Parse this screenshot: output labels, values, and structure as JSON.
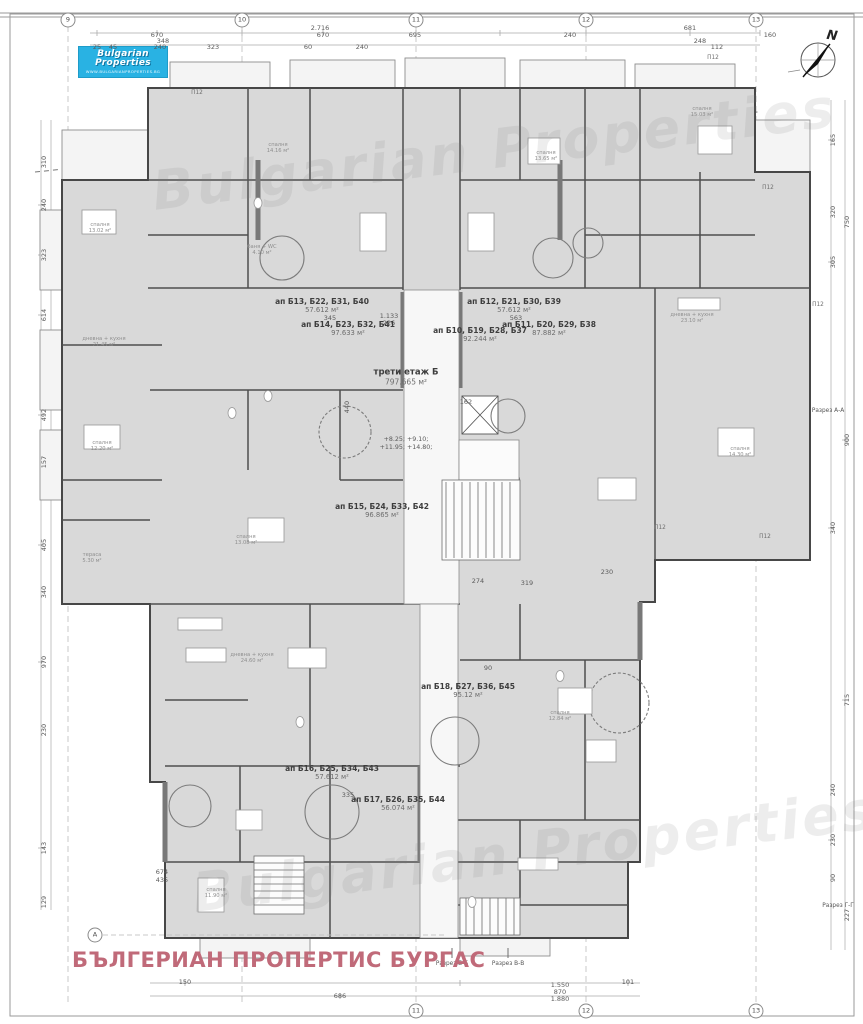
{
  "header": {
    "logo_line1": "Bulgarian",
    "logo_line2": "Properties",
    "logo_url": "WWW.BULGARIANPROPERTIES.BG",
    "north_label": "N",
    "logo_color": "#29b2e3"
  },
  "footer": {
    "agency": "БЪЛГЕРИАН ПРОПЕРТИС БУРГАС",
    "accent_color": "#c06a79"
  },
  "watermark": {
    "line1": "Bulgarian Properties",
    "line2": "Bulgarian Properties"
  },
  "plan": {
    "floor": {
      "label": "трети етаж Б",
      "area": "797.665 м²"
    },
    "elevations": {
      "line1": "+8.25; +9.10;",
      "line2": "+11.95; +14.80;"
    },
    "apartments": [
      {
        "label": "ап Б13, Б22, Б31, Б40",
        "area": "57.612 м²",
        "x": 322,
        "y": 306
      },
      {
        "label": "ап Б14, Б23, Б32, Б41",
        "area": "97.633 м²",
        "x": 348,
        "y": 329
      },
      {
        "label": "ап Б12, Б21, Б30, Б39",
        "area": "57.612 м²",
        "x": 514,
        "y": 306
      },
      {
        "label": "ап Б11, Б20, Б29, Б38",
        "area": "87.882 м²",
        "x": 549,
        "y": 329
      },
      {
        "label": "ап Б10, Б19, Б28, Б37",
        "area": "92.244 м²",
        "x": 480,
        "y": 335
      },
      {
        "label": "ап Б15, Б24, Б33, Б42",
        "area": "96.865 м²",
        "x": 382,
        "y": 511
      },
      {
        "label": "ап Б16, Б25, Б34, Б43",
        "area": "57.612 м²",
        "x": 332,
        "y": 773
      },
      {
        "label": "ап Б17, Б26, Б35, Б44",
        "area": "56.074 м²",
        "x": 398,
        "y": 804
      },
      {
        "label": "ап Б18, Б27, Б36, Б45",
        "area": "95.12 м²",
        "x": 468,
        "y": 691
      }
    ],
    "rooms": [
      {
        "name": "спалня",
        "area": "13.02 м²",
        "x": 100,
        "y": 228
      },
      {
        "name": "дневна + кухня",
        "area": "21.45 м²",
        "x": 104,
        "y": 342
      },
      {
        "name": "спалня",
        "area": "12.20 м²",
        "x": 102,
        "y": 446
      },
      {
        "name": "спалня",
        "area": "14.16 м²",
        "x": 278,
        "y": 148
      },
      {
        "name": "спалня",
        "area": "13.65 м²",
        "x": 546,
        "y": 156
      },
      {
        "name": "спалня",
        "area": "15.03 м²",
        "x": 702,
        "y": 112
      },
      {
        "name": "дневна + кухня",
        "area": "23.10 м²",
        "x": 692,
        "y": 318
      },
      {
        "name": "спалня",
        "area": "14.30 м²",
        "x": 740,
        "y": 452
      },
      {
        "name": "спалня",
        "area": "13.08 м²",
        "x": 246,
        "y": 540
      },
      {
        "name": "дневна + кухня",
        "area": "24.60 м²",
        "x": 252,
        "y": 658
      },
      {
        "name": "спалня",
        "area": "12.84 м²",
        "x": 560,
        "y": 716
      },
      {
        "name": "спалня",
        "area": "11.90 м²",
        "x": 216,
        "y": 893
      },
      {
        "name": "тераса",
        "area": "5.30 м²",
        "x": 92,
        "y": 558
      },
      {
        "name": "баня + WC",
        "area": "4.10 м²",
        "x": 262,
        "y": 250
      }
    ],
    "sections": [
      {
        "label": "Разрез А-А",
        "x": 828,
        "y": 411
      },
      {
        "label": "Разрез Г-Г",
        "x": 838,
        "y": 906
      },
      {
        "label": "Разрез Б-Б",
        "x": 452,
        "y": 964
      },
      {
        "label": "Разрез В-В",
        "x": 508,
        "y": 964
      }
    ],
    "column_notes": [
      {
        "label": "П12",
        "x": 197,
        "y": 93
      },
      {
        "label": "П12",
        "x": 713,
        "y": 58
      },
      {
        "label": "П12",
        "x": 768,
        "y": 188
      },
      {
        "label": "П12",
        "x": 818,
        "y": 305
      },
      {
        "label": "П12",
        "x": 660,
        "y": 528
      },
      {
        "label": "П12",
        "x": 765,
        "y": 537
      }
    ]
  },
  "grid": {
    "top": [
      {
        "label": "9",
        "x": 68
      },
      {
        "label": "10",
        "x": 242
      },
      {
        "label": "11",
        "x": 416
      },
      {
        "label": "12",
        "x": 586
      },
      {
        "label": "13",
        "x": 756
      }
    ],
    "bottom": [
      {
        "label": "11",
        "x": 416
      },
      {
        "label": "12",
        "x": 586
      },
      {
        "label": "13",
        "x": 756
      }
    ],
    "left": [
      {
        "label": "А",
        "x": 95,
        "y": 935
      }
    ]
  },
  "dims": [
    {
      "t": "2.716",
      "x": 320,
      "y": 28
    },
    {
      "t": "681",
      "x": 690,
      "y": 28
    },
    {
      "t": "670",
      "x": 157,
      "y": 35
    },
    {
      "t": "670",
      "x": 323,
      "y": 35
    },
    {
      "t": "695",
      "x": 415,
      "y": 35
    },
    {
      "t": "240",
      "x": 570,
      "y": 35
    },
    {
      "t": "248",
      "x": 700,
      "y": 41
    },
    {
      "t": "160",
      "x": 770,
      "y": 35
    },
    {
      "t": "25",
      "x": 97,
      "y": 47
    },
    {
      "t": "45",
      "x": 113,
      "y": 47
    },
    {
      "t": "240",
      "x": 160,
      "y": 47
    },
    {
      "t": "323",
      "x": 213,
      "y": 47
    },
    {
      "t": "348",
      "x": 163,
      "y": 41
    },
    {
      "t": "60",
      "x": 308,
      "y": 47
    },
    {
      "t": "240",
      "x": 362,
      "y": 47
    },
    {
      "t": "112",
      "x": 717,
      "y": 47
    },
    {
      "t": "310",
      "x": 44,
      "y": 162,
      "r": -90
    },
    {
      "t": "240",
      "x": 44,
      "y": 205,
      "r": -90
    },
    {
      "t": "323",
      "x": 44,
      "y": 255,
      "r": -90
    },
    {
      "t": "614",
      "x": 44,
      "y": 315,
      "r": -90
    },
    {
      "t": "492",
      "x": 44,
      "y": 415,
      "r": -90
    },
    {
      "t": "157",
      "x": 44,
      "y": 462,
      "r": -90
    },
    {
      "t": "405",
      "x": 44,
      "y": 545,
      "r": -90
    },
    {
      "t": "340",
      "x": 44,
      "y": 592,
      "r": -90
    },
    {
      "t": "970",
      "x": 44,
      "y": 662,
      "r": -90
    },
    {
      "t": "230",
      "x": 44,
      "y": 730,
      "r": -90
    },
    {
      "t": "143",
      "x": 44,
      "y": 848,
      "r": -90
    },
    {
      "t": "129",
      "x": 44,
      "y": 902,
      "r": -90
    },
    {
      "t": "674",
      "x": 162,
      "y": 872
    },
    {
      "t": "435",
      "x": 162,
      "y": 880
    },
    {
      "t": "165",
      "x": 833,
      "y": 140,
      "r": -90
    },
    {
      "t": "320",
      "x": 833,
      "y": 212,
      "r": -90
    },
    {
      "t": "305",
      "x": 833,
      "y": 262,
      "r": -90
    },
    {
      "t": "750",
      "x": 847,
      "y": 222,
      "r": -90
    },
    {
      "t": "900",
      "x": 847,
      "y": 440,
      "r": -90
    },
    {
      "t": "340",
      "x": 833,
      "y": 528,
      "r": -90
    },
    {
      "t": "715",
      "x": 847,
      "y": 700,
      "r": -90
    },
    {
      "t": "240",
      "x": 833,
      "y": 790,
      "r": -90
    },
    {
      "t": "230",
      "x": 833,
      "y": 840,
      "r": -90
    },
    {
      "t": "90",
      "x": 833,
      "y": 878,
      "r": -90
    },
    {
      "t": "227",
      "x": 847,
      "y": 915,
      "r": -90
    },
    {
      "t": "150",
      "x": 185,
      "y": 982
    },
    {
      "t": "686",
      "x": 340,
      "y": 996
    },
    {
      "t": "1.550",
      "x": 560,
      "y": 985
    },
    {
      "t": "870",
      "x": 560,
      "y": 992
    },
    {
      "t": "1.880",
      "x": 560,
      "y": 999
    },
    {
      "t": "101",
      "x": 628,
      "y": 982
    },
    {
      "t": "345",
      "x": 330,
      "y": 318
    },
    {
      "t": "1.133",
      "x": 389,
      "y": 316
    },
    {
      "t": "226",
      "x": 389,
      "y": 323
    },
    {
      "t": "563",
      "x": 516,
      "y": 318
    },
    {
      "t": "440",
      "x": 347,
      "y": 407,
      "r": -90
    },
    {
      "t": "274",
      "x": 478,
      "y": 581
    },
    {
      "t": "319",
      "x": 527,
      "y": 583
    },
    {
      "t": "335",
      "x": 348,
      "y": 795
    },
    {
      "t": "230",
      "x": 607,
      "y": 572
    },
    {
      "t": "90",
      "x": 488,
      "y": 668
    },
    {
      "t": "162",
      "x": 466,
      "y": 402
    }
  ]
}
